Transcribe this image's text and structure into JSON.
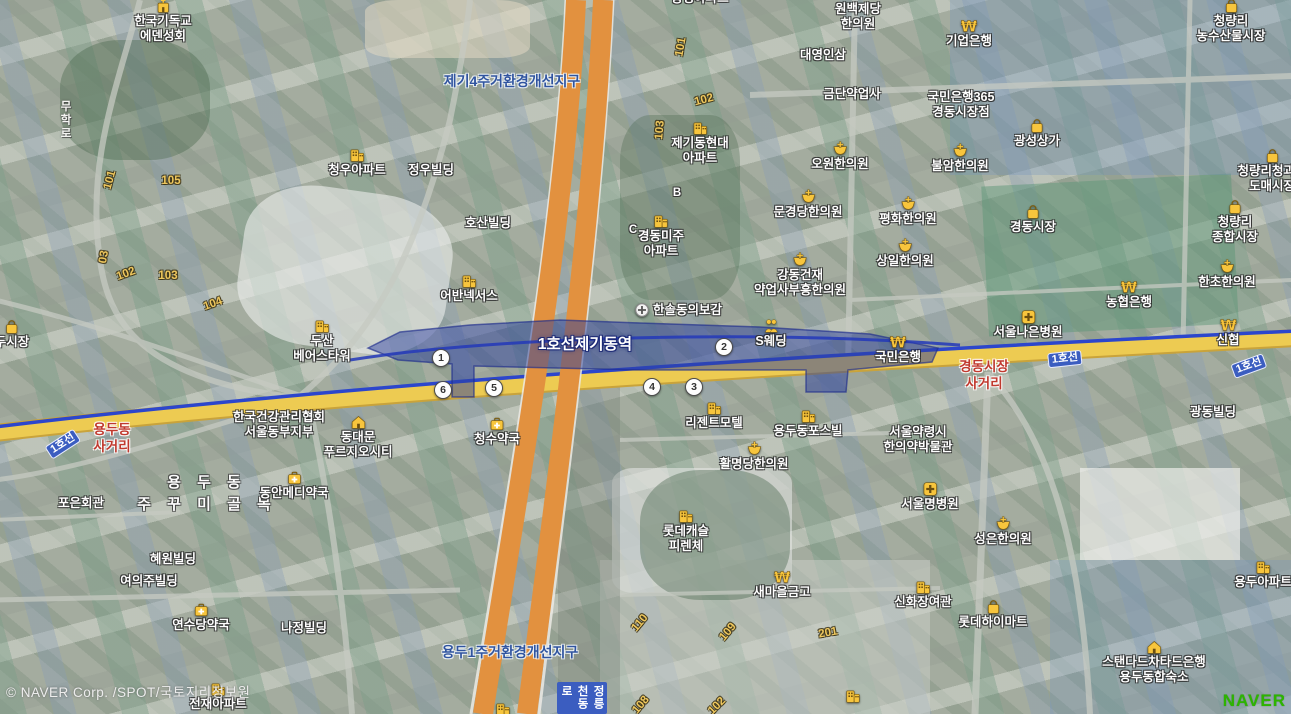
{
  "station": {
    "label": "1호선제기동역"
  },
  "copyright": "© NAVER Corp. /SPOT/국토지리정보원",
  "watermark": "NAVER",
  "colors": {
    "line1_blue": "#2c46cc",
    "road_yellow": "#edcb52",
    "highway_orange": "#e2913f",
    "poi_yellow": "#f7c53d",
    "naver_green": "#2DB400"
  },
  "exits": [
    {
      "n": "1",
      "x": 441,
      "y": 358
    },
    {
      "n": "2",
      "x": 724,
      "y": 347
    },
    {
      "n": "3",
      "x": 694,
      "y": 387
    },
    {
      "n": "4",
      "x": 652,
      "y": 387
    },
    {
      "n": "5",
      "x": 494,
      "y": 388
    },
    {
      "n": "6",
      "x": 443,
      "y": 390
    }
  ],
  "line_badges": [
    {
      "t": "1호선",
      "x": 63,
      "y": 444,
      "r": -33
    },
    {
      "t": "1호선",
      "x": 1065,
      "y": 359,
      "r": -6
    },
    {
      "t": "1호선",
      "x": 1249,
      "y": 366,
      "r": -20
    }
  ],
  "districts": [
    {
      "t": "제기4주거환경개선지구",
      "x": 512,
      "y": 71
    },
    {
      "t": "용두1주거환경개선지구",
      "x": 510,
      "y": 642
    }
  ],
  "intersections": [
    {
      "lines": [
        "용두동",
        "사거리"
      ],
      "x": 112,
      "y": 421
    },
    {
      "lines": [
        "경동시장",
        "사거리"
      ],
      "x": 984,
      "y": 358
    }
  ],
  "road_names": [
    {
      "t": "무학로",
      "x": 57,
      "y": 100,
      "badge": false
    },
    {
      "t": "정릉천동로",
      "x": 557,
      "y": 682,
      "badge": true
    }
  ],
  "street_text": {
    "lines": [
      "용 두 동",
      "주 꾸 미 골 목"
    ],
    "x": 207,
    "y": 472
  },
  "numbers": [
    {
      "t": "101",
      "x": 110,
      "y": 180,
      "r": -75
    },
    {
      "t": "105",
      "x": 171,
      "y": 181,
      "r": 0
    },
    {
      "t": "03",
      "x": 104,
      "y": 257,
      "r": -80
    },
    {
      "t": "102",
      "x": 126,
      "y": 274,
      "r": -20
    },
    {
      "t": "103",
      "x": 168,
      "y": 276,
      "r": 0
    },
    {
      "t": "104",
      "x": 213,
      "y": 304,
      "r": -20
    },
    {
      "t": "101",
      "x": 681,
      "y": 47,
      "r": -80
    },
    {
      "t": "102",
      "x": 704,
      "y": 100,
      "r": -15
    },
    {
      "t": "103",
      "x": 660,
      "y": 130,
      "r": -85
    },
    {
      "t": "B",
      "x": 677,
      "y": 193,
      "r": 0,
      "w": true
    },
    {
      "t": "C",
      "x": 633,
      "y": 230,
      "r": 0,
      "w": true
    },
    {
      "t": "110",
      "x": 640,
      "y": 623,
      "r": -50
    },
    {
      "t": "109",
      "x": 728,
      "y": 632,
      "r": -50
    },
    {
      "t": "201",
      "x": 828,
      "y": 633,
      "r": -10
    },
    {
      "t": "108",
      "x": 641,
      "y": 705,
      "r": -50
    },
    {
      "t": "102",
      "x": 717,
      "y": 706,
      "r": -45
    }
  ],
  "pois": [
    {
      "icon": "church",
      "lines": [
        "한국기독교",
        "에덴성회"
      ],
      "x": 163,
      "y": -2
    },
    {
      "icon": "building",
      "lines": [
        "청우아파트"
      ],
      "x": 357,
      "y": 147
    },
    {
      "lines": [
        "정우빌딩"
      ],
      "x": 431,
      "y": 163
    },
    {
      "lines": [
        "동성아파트"
      ],
      "x": 700,
      "y": -9
    },
    {
      "icon": "building",
      "lines": [
        "제기동현대",
        "아파트"
      ],
      "x": 700,
      "y": 120
    },
    {
      "icon": "building",
      "lines": [
        "경동미주",
        "아파트"
      ],
      "x": 661,
      "y": 213
    },
    {
      "lines": [
        "원백제당",
        "한의원"
      ],
      "x": 858,
      "y": 2
    },
    {
      "lines": [
        "대영인삼"
      ],
      "x": 823,
      "y": 48
    },
    {
      "lines": [
        "금단약업사"
      ],
      "x": 852,
      "y": 87
    },
    {
      "icon": "won",
      "lines": [
        "기업은행"
      ],
      "x": 969,
      "y": 18
    },
    {
      "lines": [
        "국민은행365",
        "경동시장점"
      ],
      "x": 961,
      "y": 90
    },
    {
      "icon": "med",
      "lines": [
        "오원한의원"
      ],
      "x": 840,
      "y": 141
    },
    {
      "icon": "med",
      "lines": [
        "불암한의원"
      ],
      "x": 960,
      "y": 143
    },
    {
      "icon": "med",
      "lines": [
        "문경당한의원"
      ],
      "x": 808,
      "y": 189
    },
    {
      "icon": "med",
      "lines": [
        "평화한의원"
      ],
      "x": 908,
      "y": 196
    },
    {
      "icon": "med",
      "lines": [
        "상일한의원"
      ],
      "x": 905,
      "y": 238
    },
    {
      "icon": "med",
      "lines": [
        "강동건재",
        "약업사부흥한의원"
      ],
      "x": 800,
      "y": 252
    },
    {
      "icon": "bag",
      "lines": [
        "청량리",
        "농수산물시장"
      ],
      "x": 1231,
      "y": -2
    },
    {
      "icon": "bag",
      "lines": [
        "광성상가"
      ],
      "x": 1037,
      "y": 118
    },
    {
      "icon": "bag",
      "lines": [
        "청량리청과물",
        "도매시장"
      ],
      "x": 1272,
      "y": 148
    },
    {
      "icon": "bag",
      "lines": [
        "경동시장"
      ],
      "x": 1033,
      "y": 204
    },
    {
      "icon": "bag",
      "lines": [
        "청량리",
        "종합시장"
      ],
      "x": 1235,
      "y": 199
    },
    {
      "icon": "med",
      "lines": [
        "한초한의원"
      ],
      "x": 1227,
      "y": 259
    },
    {
      "icon": "won",
      "lines": [
        "농협은행"
      ],
      "x": 1129,
      "y": 279
    },
    {
      "icon": "won",
      "lines": [
        "신협"
      ],
      "x": 1228,
      "y": 317
    },
    {
      "icon": "hospital",
      "lines": [
        "서울나은병원"
      ],
      "x": 1028,
      "y": 309
    },
    {
      "icon": "won",
      "lines": [
        "국민은행"
      ],
      "x": 898,
      "y": 334
    },
    {
      "icon": "wedding",
      "lines": [
        "S웨딩"
      ],
      "x": 771,
      "y": 318
    },
    {
      "icon": "circlecross",
      "lines": [
        "한솔동의보감"
      ],
      "x": 678,
      "y": 302,
      "inline": true
    },
    {
      "icon": "building",
      "lines": [
        "어반넥서스"
      ],
      "x": 469,
      "y": 273
    },
    {
      "lines": [
        "호산빌딩"
      ],
      "x": 488,
      "y": 216
    },
    {
      "icon": "building",
      "lines": [
        "두산",
        "베어스타워"
      ],
      "x": 322,
      "y": 318
    },
    {
      "icon": "bag",
      "lines": [
        "두시장"
      ],
      "x": 12,
      "y": 319
    },
    {
      "lines": [
        "한국건강관리협회",
        "서울동부지부"
      ],
      "x": 279,
      "y": 410
    },
    {
      "icon": "house",
      "lines": [
        "동대문",
        "푸르지오시티"
      ],
      "x": 358,
      "y": 414
    },
    {
      "icon": "pharmacy",
      "lines": [
        "동안메디약국"
      ],
      "x": 294,
      "y": 470
    },
    {
      "lines": [
        "포은회관"
      ],
      "x": 81,
      "y": 496
    },
    {
      "lines": [
        "혜원빌딩"
      ],
      "x": 173,
      "y": 552
    },
    {
      "lines": [
        "여의주빌딩"
      ],
      "x": 149,
      "y": 574
    },
    {
      "icon": "pharmacy",
      "lines": [
        "연수당약국"
      ],
      "x": 201,
      "y": 602
    },
    {
      "lines": [
        "나정빌딩"
      ],
      "x": 304,
      "y": 621
    },
    {
      "icon": "pharmacy",
      "lines": [
        "청수약국"
      ],
      "x": 497,
      "y": 416
    },
    {
      "icon": "building",
      "lines": [
        "리젠트모텔"
      ],
      "x": 714,
      "y": 400
    },
    {
      "icon": "building",
      "lines": [
        "용두동포스빌"
      ],
      "x": 808,
      "y": 408
    },
    {
      "icon": "med",
      "lines": [
        "활명당한의원"
      ],
      "x": 754,
      "y": 441
    },
    {
      "lines": [
        "서울약령시",
        "한의약박물관"
      ],
      "x": 918,
      "y": 425
    },
    {
      "icon": "hospital",
      "lines": [
        "서울명병원"
      ],
      "x": 930,
      "y": 481
    },
    {
      "icon": "building",
      "lines": [
        "롯데캐슬",
        "피렌체"
      ],
      "x": 686,
      "y": 508
    },
    {
      "icon": "med",
      "lines": [
        "성은한의원"
      ],
      "x": 1003,
      "y": 516
    },
    {
      "icon": "won",
      "lines": [
        "새마을금고"
      ],
      "x": 782,
      "y": 569
    },
    {
      "icon": "building",
      "lines": [
        "신화장여관"
      ],
      "x": 923,
      "y": 579
    },
    {
      "icon": "bag",
      "lines": [
        "롯데하이마트"
      ],
      "x": 993,
      "y": 599
    },
    {
      "lines": [
        "광동빌딩"
      ],
      "x": 1213,
      "y": 405
    },
    {
      "icon": "building",
      "lines": [
        "용두아파트"
      ],
      "x": 1263,
      "y": 559
    },
    {
      "icon": "house",
      "lines": [
        "스탠다드차타드은행",
        "용두동합숙소"
      ],
      "x": 1154,
      "y": 639
    },
    {
      "icon": "building",
      "lines": [
        "전재아파트"
      ],
      "x": 218,
      "y": 681
    },
    {
      "icon": "building",
      "lines": [],
      "x": 853,
      "y": 688
    },
    {
      "icon": "building",
      "lines": [],
      "x": 503,
      "y": 701
    }
  ]
}
